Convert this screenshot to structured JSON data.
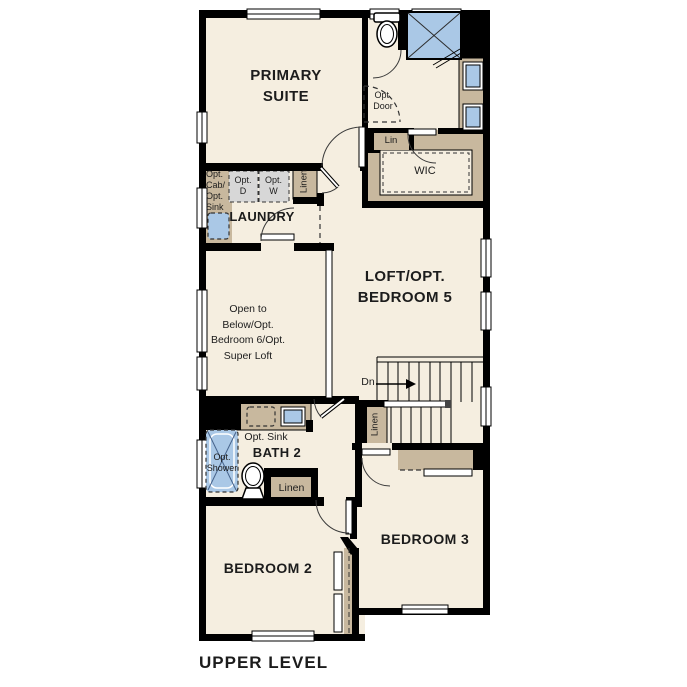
{
  "plan_title": "UPPER LEVEL",
  "rooms": {
    "primary_suite": {
      "line1": "PRIMARY",
      "line2": "SUITE"
    },
    "wic": "WIC",
    "laundry": "LAUNDRY",
    "loft": {
      "line1": "LOFT/OPT.",
      "line2": "BEDROOM 5"
    },
    "open_to_below": {
      "line1": "Open to",
      "line2": "Below/Opt.",
      "line3": "Bedroom 6/Opt.",
      "line4": "Super Loft"
    },
    "bath2": "BATH 2",
    "bedroom2": "BEDROOM 2",
    "bedroom3": "BEDROOM 3"
  },
  "fixtures": {
    "opt_door": {
      "line1": "Opt.",
      "line2": "Door"
    },
    "lin_closet": "Lin",
    "laundry_linen": "Linen",
    "opt_cab_sink": {
      "line1": "Opt.",
      "line2": "Cab/",
      "line3": "Opt.",
      "line4": "Sink"
    },
    "opt_dryer": {
      "line1": "Opt.",
      "line2": "D"
    },
    "opt_washer": {
      "line1": "Opt.",
      "line2": "W"
    },
    "stairs_down": "Dn",
    "hall_linen": "Linen",
    "opt_sink": "Opt. Sink",
    "opt_shower": {
      "line1": "Opt.",
      "line2": "Shower"
    },
    "bath_linen": "Linen"
  },
  "colors": {
    "floor": "#f5eee0",
    "wall": "#000000",
    "cabinet_tan": "#c8b89e",
    "fixture_blue": "#aac8e6",
    "appliance_gray": "#d7d7d7"
  }
}
